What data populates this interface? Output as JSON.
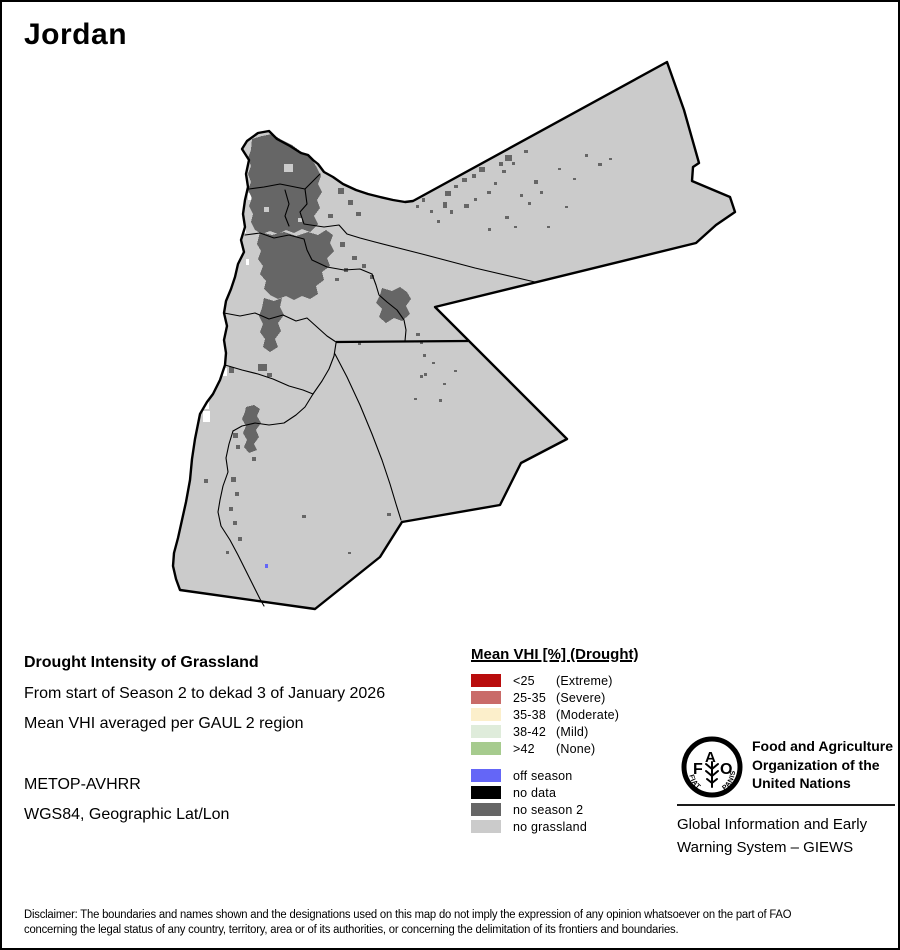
{
  "page": {
    "title": "Jordan"
  },
  "info": {
    "heading": "Drought Intensity of Grassland",
    "line1": "From start of Season 2 to dekad 3 of January 2026",
    "line2": "Mean VHI averaged per GAUL 2 region",
    "line3": "METOP-AVHRR",
    "line4": "WGS84, Geographic Lat/Lon"
  },
  "legend": {
    "title": "Mean VHI [%] (Drought)",
    "vhi_classes": [
      {
        "range": "<25",
        "label": "(Extreme)",
        "color": "#b90c0c"
      },
      {
        "range": "25-35",
        "label": "(Severe)",
        "color": "#c96b69"
      },
      {
        "range": "35-38",
        "label": "(Moderate)",
        "color": "#fcefcb"
      },
      {
        "range": "38-42",
        "label": "(Mild)",
        "color": "#dfecdb"
      },
      {
        "range": ">42",
        "label": "(None)",
        "color": "#a6cb8e"
      }
    ],
    "status_classes": [
      {
        "label": "off season",
        "color": "#6466f7"
      },
      {
        "label": "no data",
        "color": "#000000"
      },
      {
        "label": "no season 2",
        "color": "#666666"
      },
      {
        "label": "no grassland",
        "color": "#cbcbcb"
      }
    ]
  },
  "map_colors": {
    "no_grassland_fill": "#cbcbcb",
    "no_season2_patch": "#666666",
    "off_season_dot": "#6466f7",
    "boundary": "#000000",
    "background": "#ffffff"
  },
  "fao": {
    "org_line1": "Food and Agriculture",
    "org_line2": "Organization of the",
    "org_line3": "United Nations",
    "giews_line1": "Global Information and Early",
    "giews_line2": "Warning System – GIEWS",
    "logo_f": "F",
    "logo_a": "A",
    "logo_o": "O",
    "motto_left": "FIAT",
    "motto_right": "PANIS"
  },
  "disclaimer": {
    "line1": "Disclaimer: The boundaries and names shown and the designations used on this map do not imply the expression of any opinion whatsoever on the part of FAO",
    "line2": "concerning the legal status of any country, territory, area or of its authorities, or concerning the delimitation of its frontiers and boundaries."
  }
}
